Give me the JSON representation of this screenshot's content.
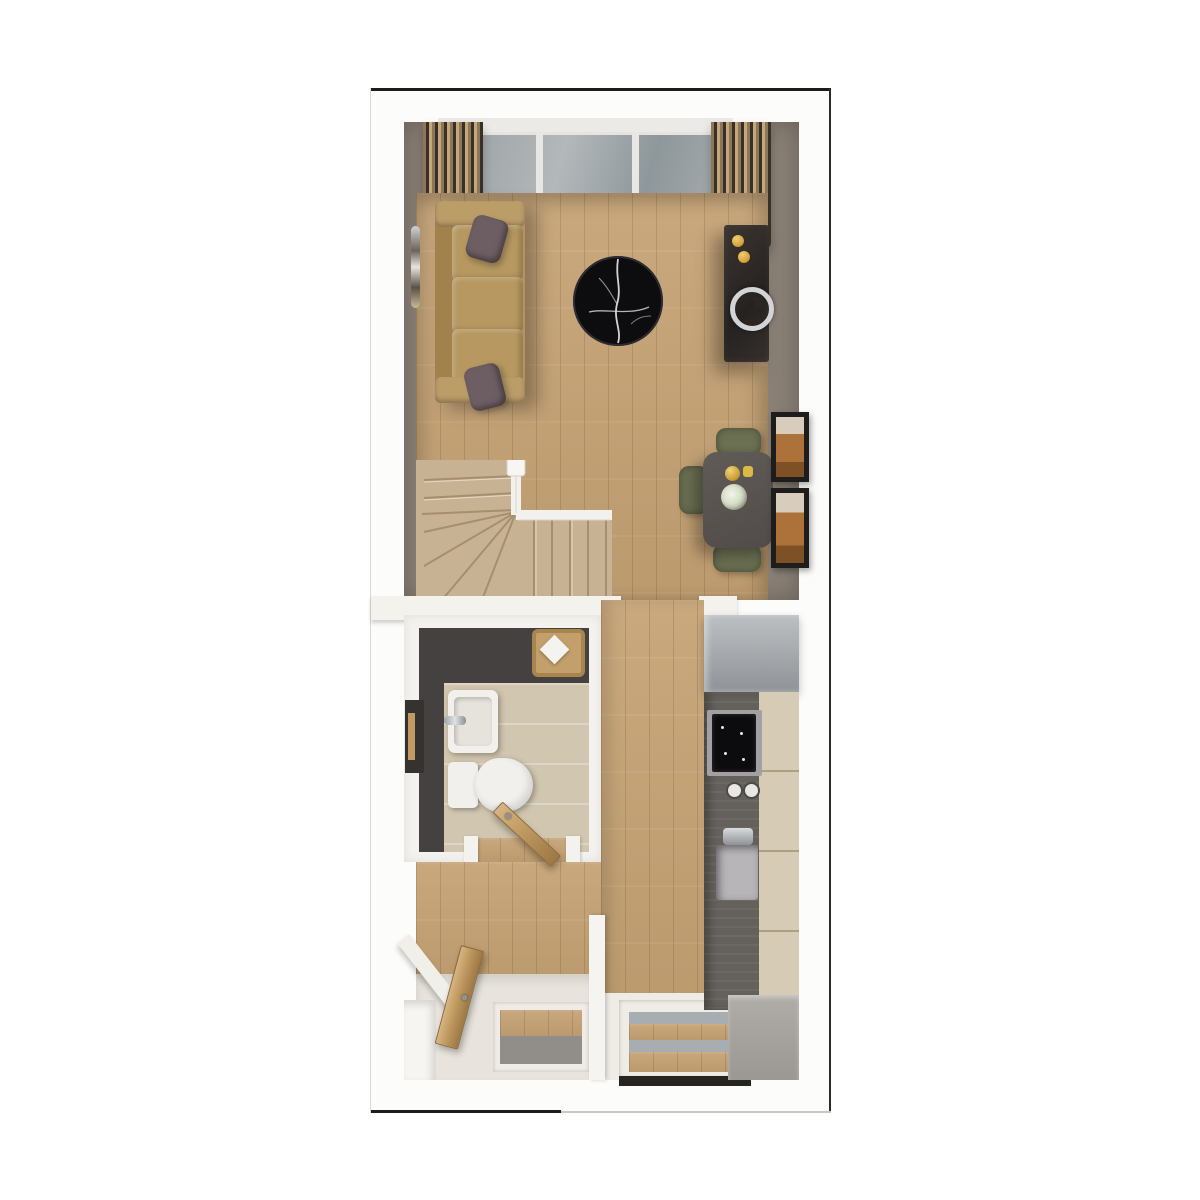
{
  "image_type": "3d-floor-plan-render-top-view",
  "plan": {
    "rooms": [
      {
        "name": "living-room",
        "items": [
          "picture-window",
          "curtain-left",
          "curtain-right",
          "sofa",
          "throw-pillow-top",
          "throw-pillow-bottom",
          "wall-mirror",
          "round-marble-coffee-table",
          "media-console",
          "candle-pair",
          "ring-ornament"
        ]
      },
      {
        "name": "dining-area",
        "items": [
          "dining-table",
          "gold-vase",
          "gold-cup",
          "flower-bowl",
          "dining-chair-top",
          "dining-chair-left",
          "dining-chair-bottom",
          "wall-frame-upper",
          "wall-frame-lower"
        ]
      },
      {
        "name": "staircase",
        "items": [
          "winder-stairs",
          "handrail",
          "newel-post"
        ]
      },
      {
        "name": "bathroom",
        "items": [
          "washbasin",
          "toilet",
          "towel-basket",
          "towel",
          "towel-rail-panel",
          "door-threshold"
        ]
      },
      {
        "name": "hallway",
        "items": [
          "open-bathroom-door",
          "open-front-door",
          "under-stair-ledge",
          "storage-nook",
          "doormat-recess",
          "entry-tiles"
        ]
      },
      {
        "name": "kitchen",
        "items": [
          "tall-unit",
          "worktop",
          "hob",
          "jar-pair",
          "sink",
          "faucet",
          "base-cabinets",
          "appliance-block",
          "front-door-glazing",
          "door-threshold-strip"
        ]
      }
    ],
    "counts": {
      "dining_chairs": 3,
      "wall_frames": 2,
      "throw_pillows": 2,
      "open_doors": 2,
      "window_panes": 3
    }
  },
  "palette": {
    "outline": "#1c1c1c",
    "wall_gray": "#8a8076",
    "wood": "#c9a87d",
    "wood_dark": "#bb9a6e",
    "carpet": "#c8b294",
    "sofa": "#b2945f",
    "pillow": "#6d5e64",
    "table_black": "#0d0d0f",
    "gold": "#d4a33a",
    "chair_olive": "#6b7052",
    "frame_art": "#ad713a",
    "bath_floor": "#454140",
    "tile": "#d1c6af",
    "fixture_white": "#f2f0ec",
    "counter": "#64605b",
    "hob": "#0c0c0e",
    "unit_gray": "#8f9397",
    "cabinet": "#d6cbb4",
    "door_wood": "#c29b62",
    "glass": "#a7adb0",
    "mat_gray": "#918d88",
    "threshold": "#262320",
    "appliance": "#9b9792"
  }
}
